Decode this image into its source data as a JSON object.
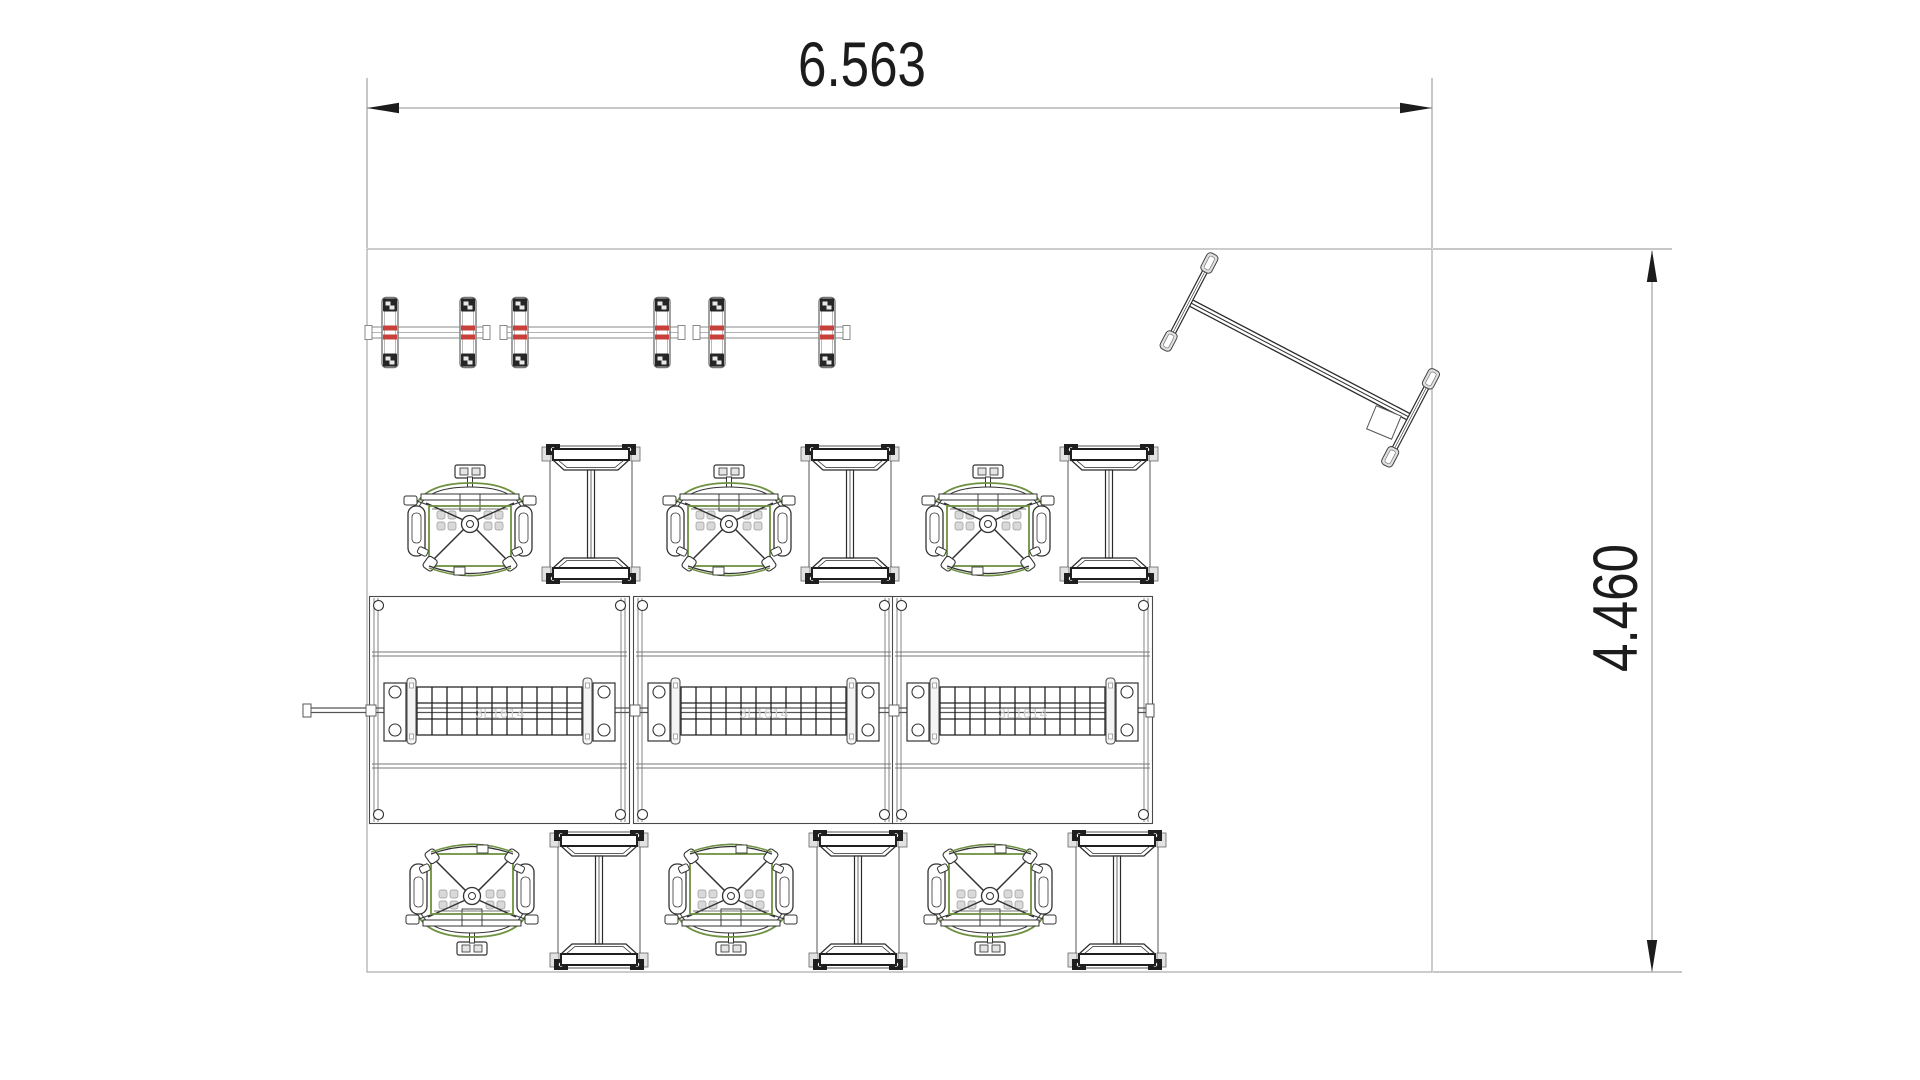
{
  "page": {
    "background": "#ffffff",
    "kind": "cad-floor-plan-drawing"
  },
  "drawing": {
    "dim_h": {
      "label": "6.563",
      "x1": 367,
      "x2": 1432,
      "y": 108,
      "text_x": 862,
      "text_y": 86
    },
    "dim_v": {
      "label": "4.460",
      "y1": 250,
      "y2": 972,
      "x": 1652,
      "text_x": 1637,
      "text_y": 608
    },
    "part_label": "3L1614",
    "colors": {
      "boundary": "#a3a3a3",
      "dim_line": "#8f8f8f",
      "dim_ink": "#1c1c1c",
      "furniture_dark": "#2b2b2b",
      "accent_green": "#6e9140",
      "accent_red": "#c8403a",
      "faint_label": "#cfcfcf"
    },
    "room": {
      "x": 367,
      "y": 249,
      "width": 1065,
      "height": 723
    },
    "shelves": [
      {
        "x1": 365,
        "x2": 490,
        "y": 327,
        "posts": [
          390,
          468
        ]
      },
      {
        "x1": 500,
        "x2": 685,
        "y": 327,
        "posts": [
          520,
          662
        ]
      },
      {
        "x1": 693,
        "x2": 850,
        "y": 327,
        "posts": [
          717,
          827
        ]
      }
    ],
    "chairs": [
      {
        "x": 470,
        "y": 521,
        "flip": false
      },
      {
        "x": 729,
        "y": 521,
        "flip": false
      },
      {
        "x": 988,
        "y": 521,
        "flip": false
      },
      {
        "x": 472,
        "y": 899,
        "flip": true
      },
      {
        "x": 731,
        "y": 899,
        "flip": true
      },
      {
        "x": 990,
        "y": 899,
        "flip": true
      }
    ],
    "side_tables": [
      {
        "x": 591,
        "y": 514
      },
      {
        "x": 850,
        "y": 514
      },
      {
        "x": 1109,
        "y": 514
      },
      {
        "x": 599,
        "y": 900
      },
      {
        "x": 858,
        "y": 900
      },
      {
        "x": 1117,
        "y": 900
      }
    ],
    "desks": [
      {
        "x": 369,
        "y": 596
      },
      {
        "x": 633,
        "y": 596
      },
      {
        "x": 892,
        "y": 596
      }
    ],
    "desk_rail": {
      "x1": 303,
      "x2": 1154,
      "y": 707
    },
    "whiteboard": {
      "x": 1189,
      "y": 302,
      "angle": 27.6,
      "length": 250
    }
  }
}
